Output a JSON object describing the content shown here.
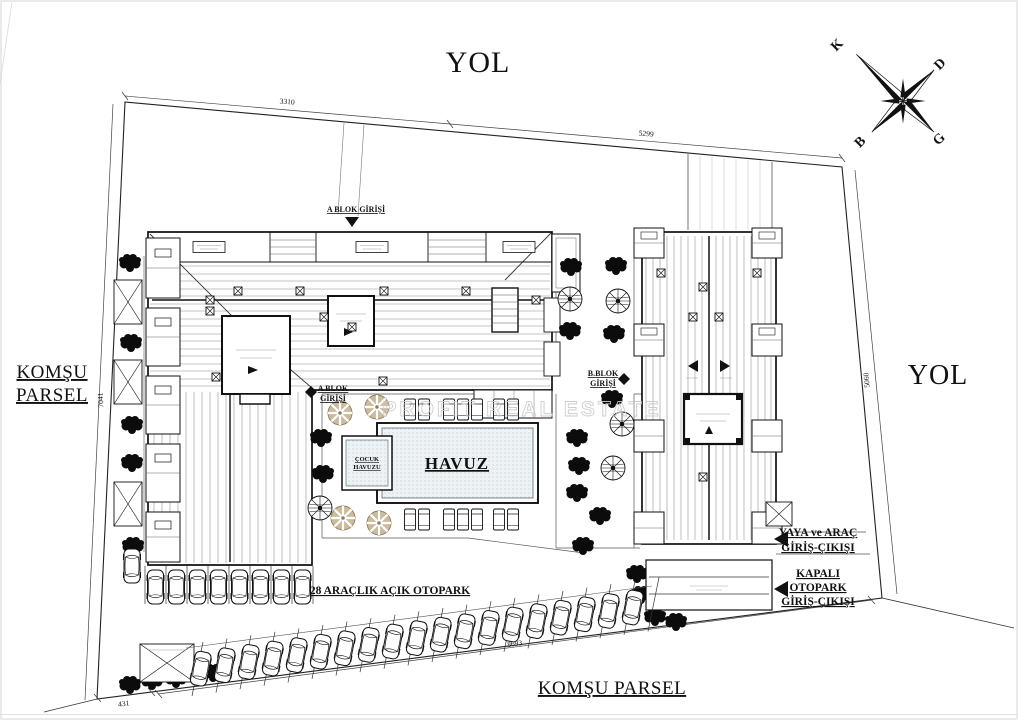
{
  "roads": {
    "top": "YOL",
    "right": "YOL"
  },
  "neighbors": {
    "left1": "KOMŞU",
    "left2": "PARSEL",
    "bottom": "KOMŞU PARSEL"
  },
  "compass": {
    "n": "K",
    "e": "D",
    "w": "B",
    "s": "G"
  },
  "dims": {
    "top_a": "3310",
    "top_b": "5299",
    "left": "7041",
    "right": "5060",
    "bottom": "8693",
    "corner": "431"
  },
  "entrances": {
    "a_top": "A BLOK GİRİŞİ",
    "a_court1": "A BLOK",
    "a_court2": "GİRİŞİ",
    "b1": "B.BLOK",
    "b2": "GİRİŞİ",
    "gate1": "YAYA ve ARAÇ",
    "gate2": "GİRİŞ-ÇIKIŞI",
    "garage1": "KAPALI",
    "garage2": "OTOPARK",
    "garage3": "GİRİŞ-ÇIKIŞI"
  },
  "pool": {
    "main": "HAVUZ",
    "kids1": "ÇOCUK",
    "kids2": "HAVUZU"
  },
  "parking": {
    "open": "28 ARAÇLIK AÇIK OTOPARK"
  },
  "watermark": "PROFIT REAL ESTATE",
  "colors": {
    "ink": "#1a1a1a",
    "parasol": "#cbbb9c",
    "pool_fill": "#e9eff1",
    "watermark": "#c9c9c9"
  }
}
